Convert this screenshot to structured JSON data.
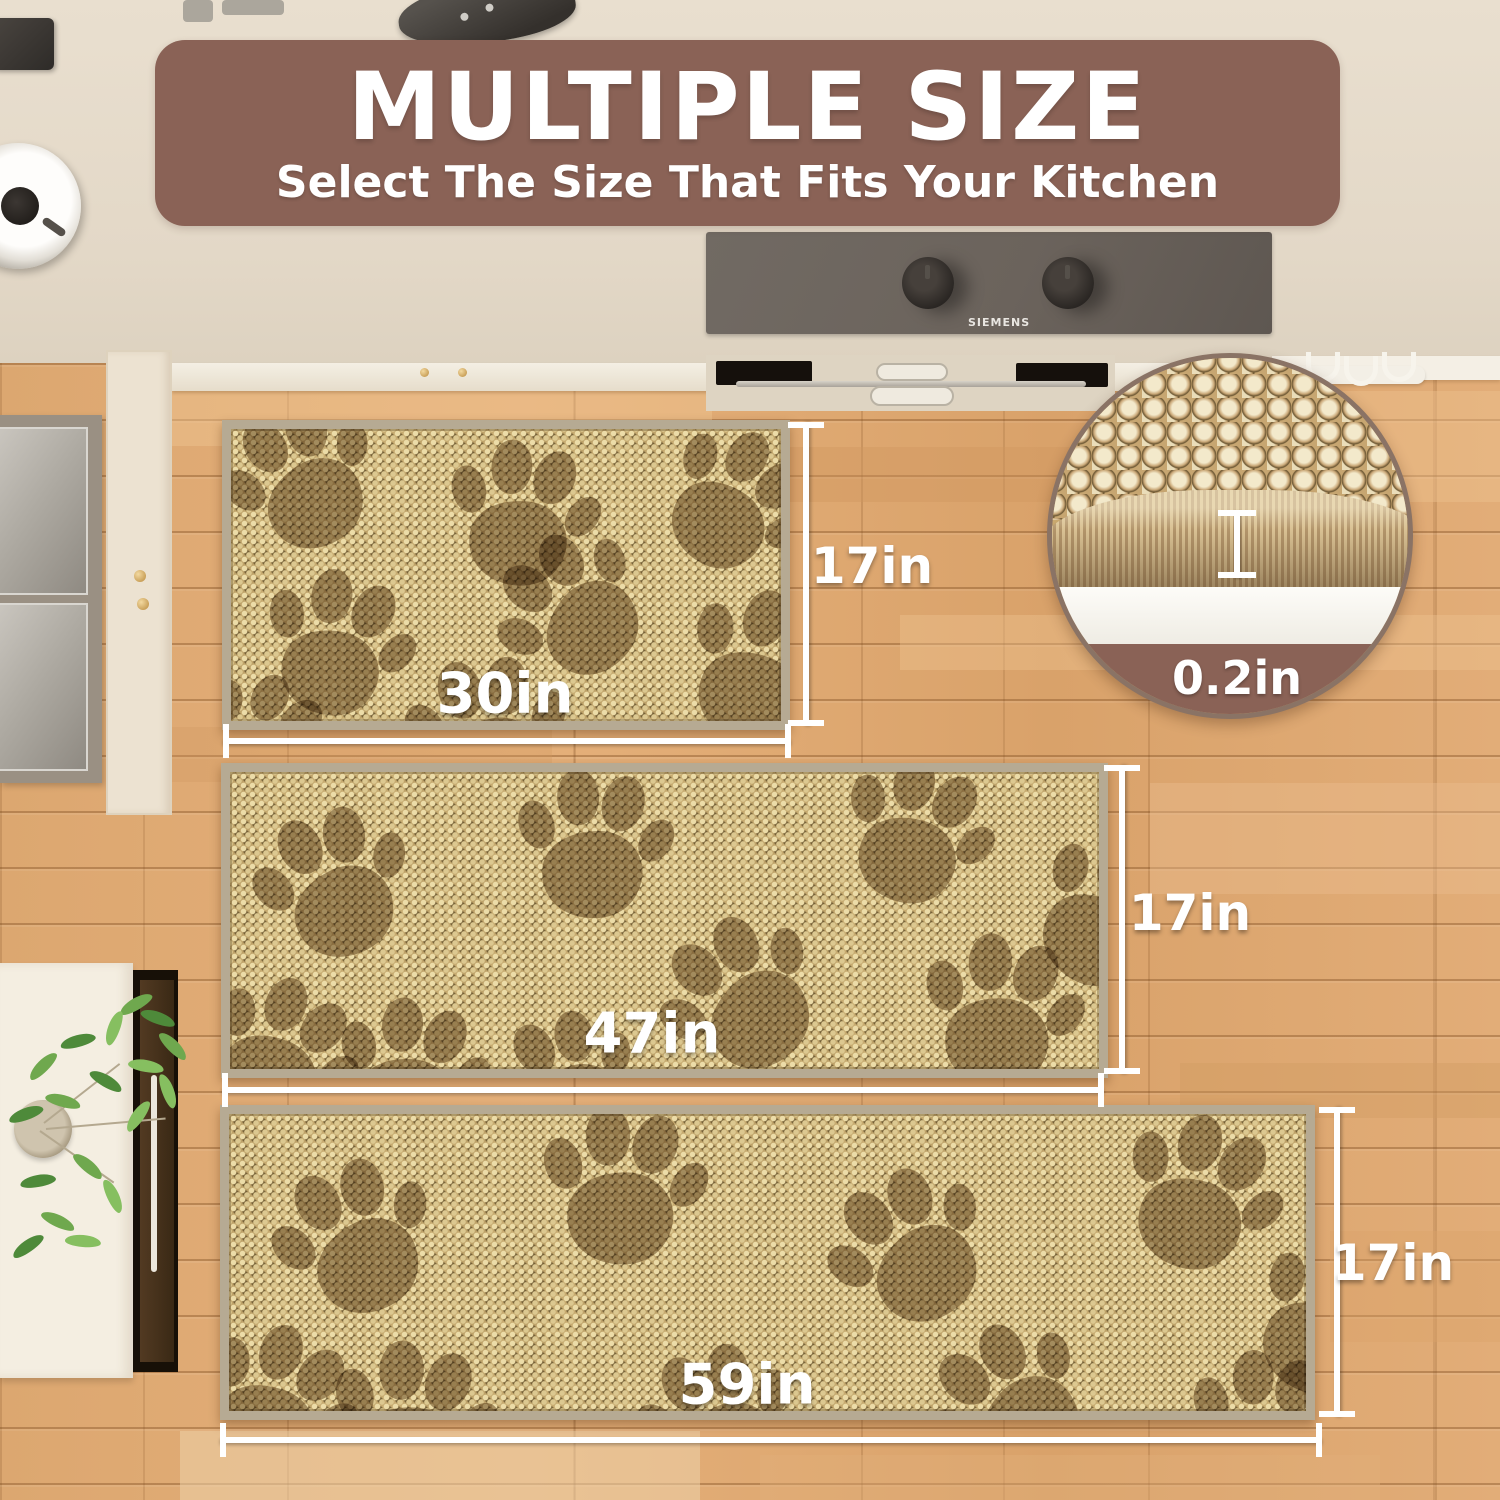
{
  "header": {
    "title": "MULTIPLE SIZE",
    "subtitle": "Select The Size That Fits Your Kitchen"
  },
  "rugs": [
    {
      "name": "small-rug",
      "width_label": "30in",
      "height_label": "17in"
    },
    {
      "name": "medium-rug",
      "width_label": "47in",
      "height_label": "17in"
    },
    {
      "name": "large-rug",
      "width_label": "59in",
      "height_label": "17in"
    }
  ],
  "thickness": {
    "label": "0.2in"
  },
  "appliance": {
    "brand": "SIEMENS"
  },
  "colors": {
    "banner": "#8a6256",
    "dimension_marks": "#ffffff",
    "rug_base": "#c6aa70",
    "rug_border": "#b6aa93",
    "paw_print": "#6e5531",
    "floor_wood": "#dfa873"
  }
}
